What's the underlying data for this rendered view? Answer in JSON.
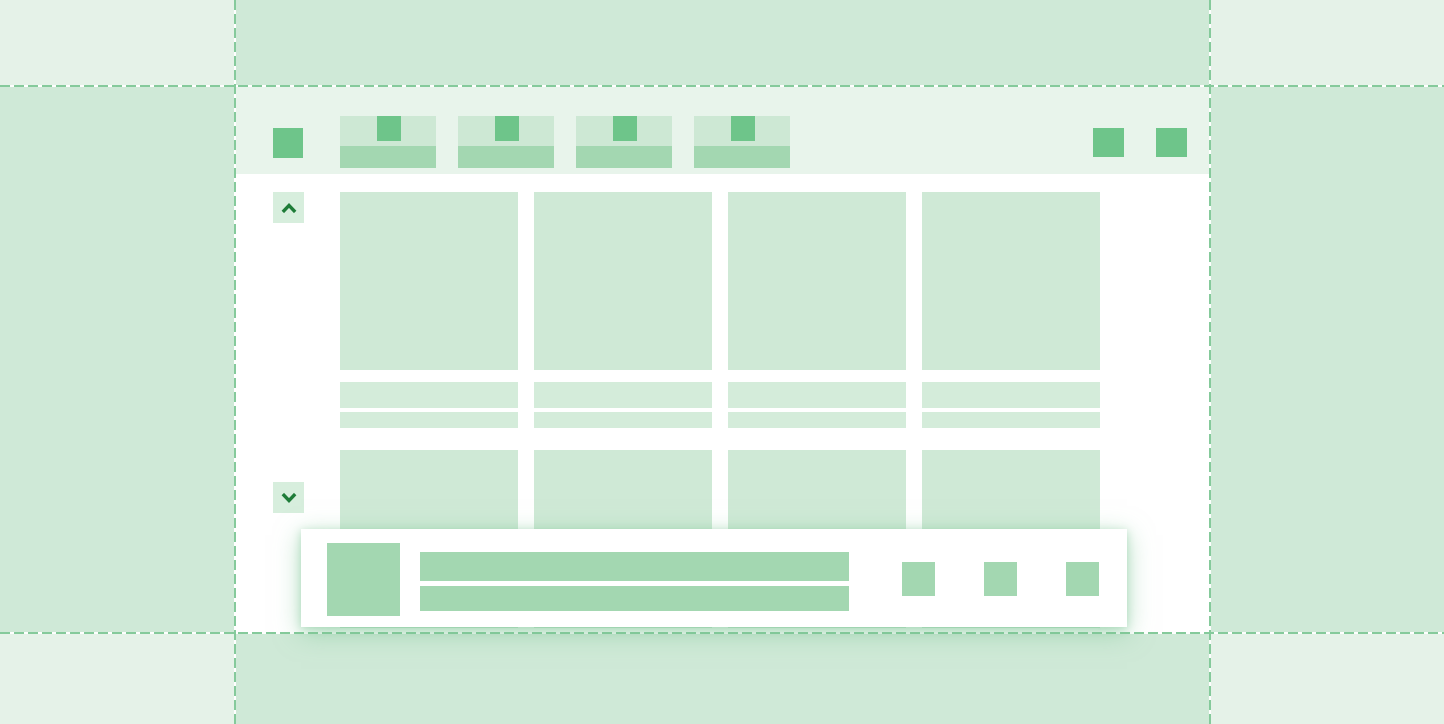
{
  "description": "Green skeleton wireframe illustration of an application window with a tab strip, a four-column media card grid, scroll up/down buttons and a notification bar, centered inside dashed guide regions",
  "palette": {
    "bg_light": "#e5f2e8",
    "bg_medium": "#cfe9d7",
    "toolbar_bg": "#e8f4eb",
    "surface": "#ffffff",
    "card_fill": "#cfe9d6",
    "card_line_fill": "#d4ecda",
    "tab_top_fill": "#cde8d4",
    "bar_fill": "#a3d7b1",
    "accent": "#6ec58a",
    "chevron_button_bg": "#d7eedd",
    "chevron_icon": "#1e7c38",
    "dash_line": "#85ca9b",
    "toast_shadow": "rgba(123,197,148,0.55)"
  },
  "toolbar": {
    "app_button_icon": "app-square-icon",
    "tab_count": 4,
    "tab_favicon_icon": "favicon-placeholder-icon",
    "window_control_count": 2
  },
  "scrollbar": {
    "up_icon": "chevron-up-icon",
    "down_icon": "chevron-down-icon"
  },
  "content_grid": {
    "columns": 4,
    "visible_rows": 2,
    "text_lines_per_card": 2
  },
  "toast": {
    "has_thumbnail": true,
    "text_line_count": 2,
    "action_button_count": 3
  }
}
